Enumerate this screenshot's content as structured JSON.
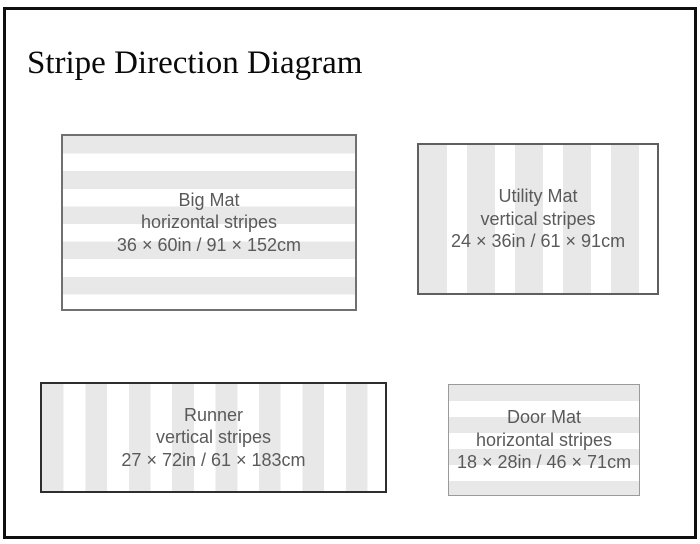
{
  "page": {
    "title": "Stripe Direction Diagram"
  },
  "colors": {
    "page_background": "#ffffff",
    "outer_border": "#0f0f0f",
    "title_text": "#0a0a0a",
    "stripe_gray": "#e8e8e9",
    "stripe_white": "#ffffff",
    "label_text": "#5a5a5a"
  },
  "mats": [
    {
      "name": "Big Mat",
      "direction_label": "horizontal stripes",
      "size_label": "36 × 60in / 91 × 152cm",
      "stripe_direction": "horizontal",
      "border_color": "#707070"
    },
    {
      "name": "Utility Mat",
      "direction_label": "vertical stripes",
      "size_label": "24 × 36in / 61 × 91cm",
      "stripe_direction": "vertical",
      "border_color": "#5f5f5f"
    },
    {
      "name": "Runner",
      "direction_label": "vertical stripes",
      "size_label": "27 × 72in / 61 × 183cm",
      "stripe_direction": "vertical",
      "border_color": "#2e2e2e"
    },
    {
      "name": "Door Mat",
      "direction_label": "horizontal stripes",
      "size_label": "18 × 28in / 46 × 71cm",
      "stripe_direction": "horizontal",
      "border_color": "#9a9a9a"
    }
  ]
}
